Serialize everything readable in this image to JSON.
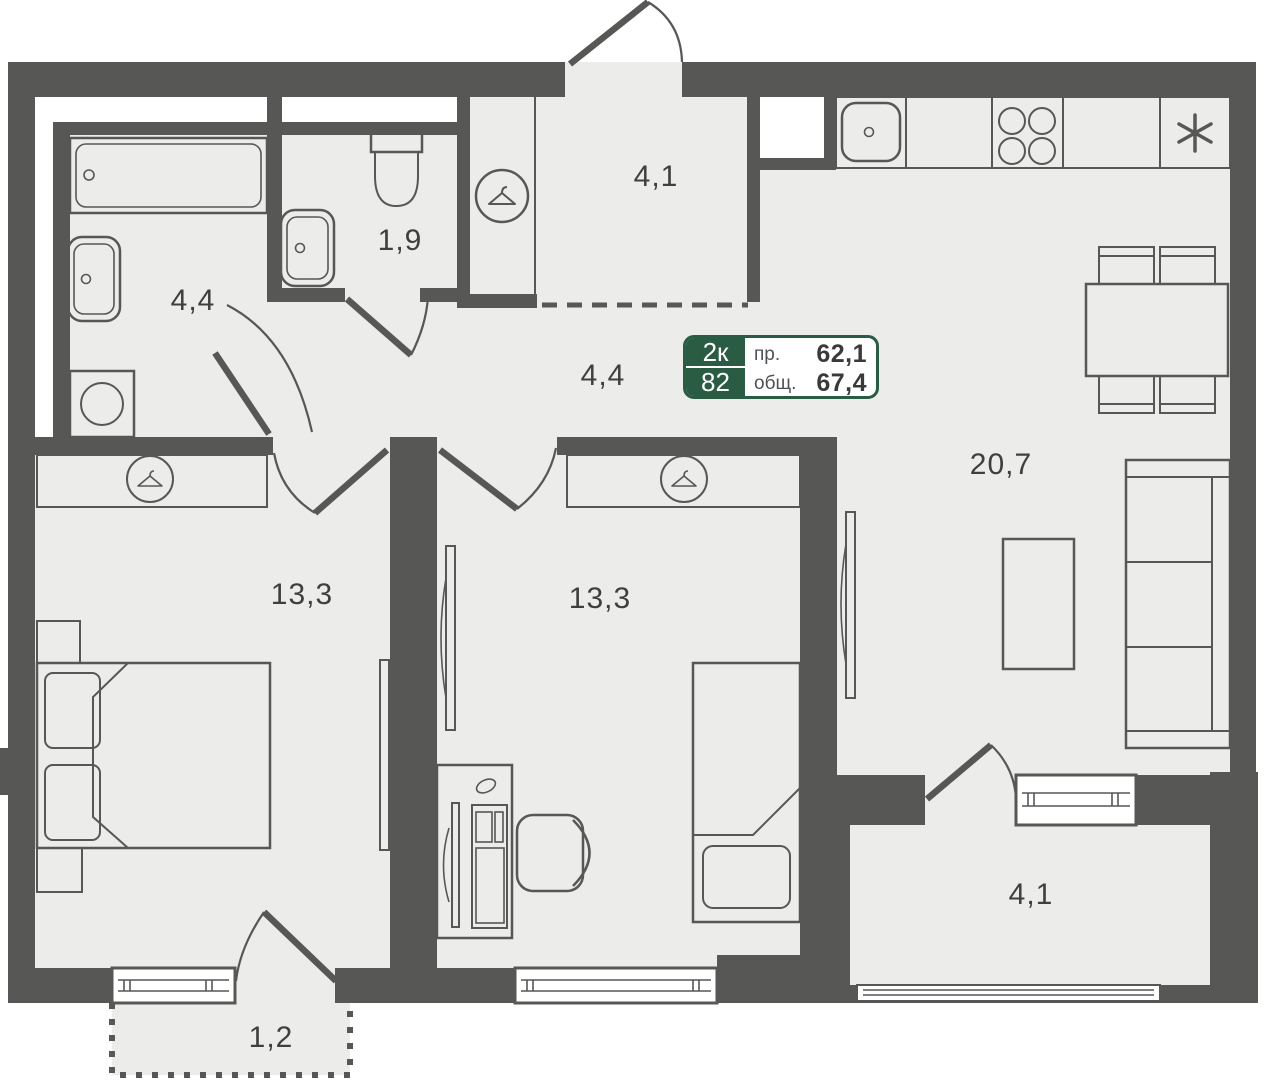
{
  "plan": {
    "badge": {
      "left_top": "2к",
      "left_bottom": "82",
      "rows": [
        {
          "label": "пр.",
          "value": "62,1"
        },
        {
          "label": "общ.",
          "value": "67,4"
        }
      ]
    },
    "rooms": {
      "bathroom": {
        "area": "4,4"
      },
      "toilet": {
        "area": "1,9"
      },
      "entry_zone": {
        "area": "4,1"
      },
      "hallway": {
        "area": "4,4"
      },
      "kitchen_living": {
        "area": "20,7"
      },
      "bedroom_1": {
        "area": "13,3"
      },
      "bedroom_2": {
        "area": "13,3"
      },
      "loggia": {
        "area": "4,1"
      },
      "balcony": {
        "area": "1,2"
      }
    },
    "colors": {
      "wall": "#575755",
      "floor": "#ececeb",
      "badge_green": "#2a5c43",
      "text": "#3f3f3e"
    }
  }
}
